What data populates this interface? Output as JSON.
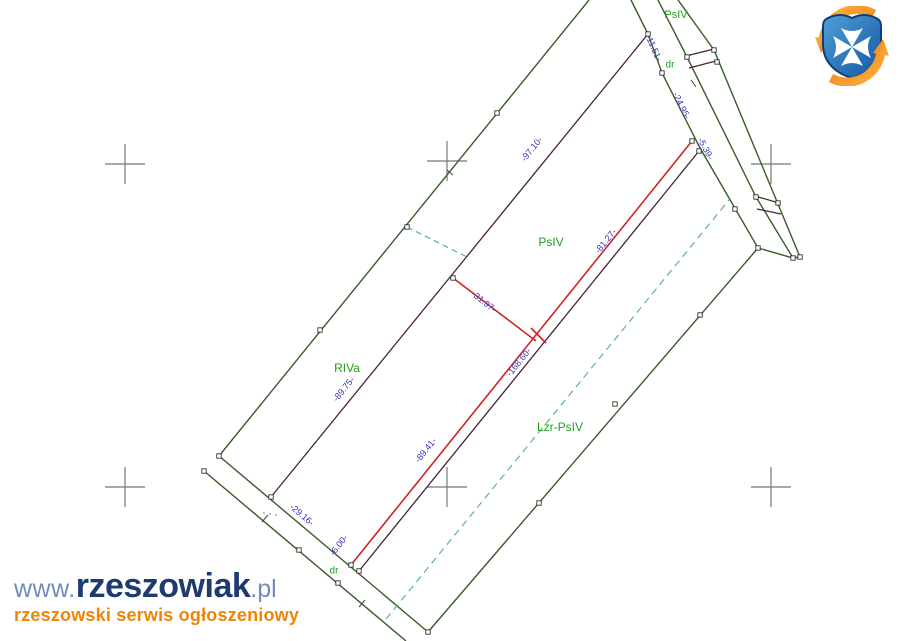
{
  "canvas": {
    "width": 900,
    "height": 641,
    "background": "#ffffff"
  },
  "colors": {
    "boundary": "#3a5c28",
    "inner": "#4a2433",
    "red": "#cf2323",
    "dashed": "#5cb87e",
    "measure": "#3434bb",
    "parcel": "#1fa01f",
    "cross": "#787878",
    "marker_fill": "#ffffff",
    "marker_stroke": "#333333",
    "tick": "#444444",
    "crest_blue_light": "#4f9fd8",
    "crest_blue_dark": "#1356a0",
    "crest_orange": "#f6921e",
    "wm_blue_light": "#6f8cba",
    "wm_blue_dark": "#1e3a6e",
    "wm_orange": "#ee8508"
  },
  "map": {
    "lines": [
      {
        "name": "outer-nw-boundary",
        "color": "boundary",
        "width": 1.4,
        "points": [
          [
            219,
            456
          ],
          [
            589,
            0
          ]
        ]
      },
      {
        "name": "outer-sw-boundary",
        "color": "boundary",
        "width": 1.4,
        "points": [
          [
            219,
            456
          ],
          [
            428,
            632
          ]
        ]
      },
      {
        "name": "road-sw-lower-edge",
        "color": "boundary",
        "width": 1.4,
        "points": [
          [
            204,
            471
          ],
          [
            406,
            641
          ]
        ]
      },
      {
        "name": "outer-se-boundary",
        "color": "boundary",
        "width": 1.4,
        "points": [
          [
            428,
            632
          ],
          [
            758,
            248
          ]
        ]
      },
      {
        "name": "road-ne-edge-a",
        "color": "boundary",
        "width": 1.4,
        "points": [
          [
            631,
            0
          ],
          [
            648,
            34
          ],
          [
            662,
            73
          ],
          [
            700,
            148
          ],
          [
            758,
            248
          ]
        ]
      },
      {
        "name": "road-ne-edge-b",
        "color": "boundary",
        "width": 1.4,
        "points": [
          [
            658,
            0
          ],
          [
            687,
            57
          ],
          [
            756,
            197
          ],
          [
            793,
            258
          ]
        ]
      },
      {
        "name": "road-ne-edge-c",
        "color": "boundary",
        "width": 1.4,
        "points": [
          [
            678,
            0
          ],
          [
            714,
            50
          ],
          [
            800,
            257
          ]
        ]
      },
      {
        "name": "road-ne-bottom-edge",
        "color": "boundary",
        "width": 1.4,
        "points": [
          [
            758,
            248
          ],
          [
            793,
            258
          ],
          [
            800,
            257
          ]
        ]
      },
      {
        "name": "inner-boundary-long",
        "color": "inner",
        "width": 1.3,
        "points": [
          [
            648,
            34
          ],
          [
            271,
            497
          ]
        ]
      },
      {
        "name": "inner-boundary-parallel",
        "color": "inner",
        "width": 1.3,
        "points": [
          [
            359,
            571
          ],
          [
            699,
            151
          ]
        ]
      },
      {
        "name": "road-rung-1",
        "color": "inner",
        "width": 1.2,
        "points": [
          [
            686,
            56
          ],
          [
            714,
            49
          ]
        ]
      },
      {
        "name": "road-rung-2",
        "color": "inner",
        "width": 1.2,
        "points": [
          [
            689,
            68
          ],
          [
            716,
            61
          ]
        ]
      },
      {
        "name": "road-rung-3",
        "color": "inner",
        "width": 1.2,
        "points": [
          [
            755,
            196
          ],
          [
            779,
            203
          ]
        ]
      },
      {
        "name": "road-rung-4",
        "color": "inner",
        "width": 1.2,
        "points": [
          [
            757,
            209
          ],
          [
            781,
            214
          ]
        ]
      },
      {
        "name": "division-red-main",
        "color": "red",
        "width": 1.6,
        "points": [
          [
            351,
            565
          ],
          [
            692,
            141
          ]
        ]
      },
      {
        "name": "division-red-spur",
        "color": "red",
        "width": 1.6,
        "points": [
          [
            453,
            278
          ],
          [
            536,
            341
          ]
        ]
      },
      {
        "name": "division-red-tick",
        "color": "red",
        "width": 1.6,
        "points": [
          [
            531,
            328
          ],
          [
            546,
            343
          ]
        ]
      },
      {
        "name": "dashed-connector",
        "color": "dashed",
        "width": 1.2,
        "dash": "6,4",
        "points": [
          [
            407,
            227
          ],
          [
            467,
            257
          ]
        ]
      },
      {
        "name": "dashed-long",
        "color": "dashed",
        "width": 1.2,
        "dash": "7,5",
        "points": [
          [
            386,
            619
          ],
          [
            729,
            200
          ]
        ]
      }
    ],
    "measurements": [
      {
        "text": "-11.51-",
        "x": 651,
        "y": 49,
        "rot": 66
      },
      {
        "text": "-24.95-",
        "x": 679,
        "y": 107,
        "rot": 64
      },
      {
        "text": "-5.39-",
        "x": 703,
        "y": 150,
        "rot": 62
      },
      {
        "text": "-97.10-",
        "x": 534,
        "y": 151,
        "rot": -51
      },
      {
        "text": "-81.27-",
        "x": 608,
        "y": 243,
        "rot": -51
      },
      {
        "text": "-31.97-",
        "x": 482,
        "y": 304,
        "rot": 38
      },
      {
        "text": "-168.60-",
        "x": 521,
        "y": 364,
        "rot": -51
      },
      {
        "text": "-89.75-",
        "x": 346,
        "y": 391,
        "rot": -51
      },
      {
        "text": "-89.41-",
        "x": 428,
        "y": 452,
        "rot": -51
      },
      {
        "text": "-29.16-",
        "x": 300,
        "y": 517,
        "rot": 40
      },
      {
        "text": "-6.00-",
        "x": 341,
        "y": 547,
        "rot": -52
      }
    ],
    "parcel_labels": [
      {
        "text": "PsIV",
        "x": 676,
        "y": 14,
        "size": 11
      },
      {
        "text": "dr",
        "x": 670,
        "y": 64,
        "size": 10
      },
      {
        "text": "PsIV",
        "x": 551,
        "y": 242,
        "size": 12
      },
      {
        "text": "RIVa",
        "x": 347,
        "y": 368,
        "size": 12
      },
      {
        "text": "Lzr-PsIV",
        "x": 560,
        "y": 427,
        "size": 12
      },
      {
        "text": "dr",
        "x": 334,
        "y": 570,
        "size": 10
      }
    ],
    "markers": [
      [
        497,
        113
      ],
      [
        407,
        227
      ],
      [
        320,
        330
      ],
      [
        219,
        456
      ],
      [
        271,
        497
      ],
      [
        204,
        471
      ],
      [
        299,
        550
      ],
      [
        338,
        583
      ],
      [
        428,
        632
      ],
      [
        539,
        503
      ],
      [
        615,
        404
      ],
      [
        700,
        315
      ],
      [
        758,
        248
      ],
      [
        648,
        34
      ],
      [
        662,
        73
      ],
      [
        735,
        209
      ],
      [
        687,
        57
      ],
      [
        756,
        197
      ],
      [
        793,
        258
      ],
      [
        714,
        50
      ],
      [
        717,
        62
      ],
      [
        778,
        203
      ],
      [
        800,
        257
      ],
      [
        453,
        278
      ],
      [
        351,
        565
      ],
      [
        359,
        571
      ],
      [
        692,
        141
      ],
      [
        699,
        151
      ]
    ],
    "ticks": [
      [
        447,
        170,
        453,
        175
      ],
      [
        262,
        522,
        268,
        515
      ],
      [
        359,
        607,
        365,
        600
      ],
      [
        691,
        80,
        696,
        87
      ]
    ],
    "dots": [
      [
        264,
        513
      ],
      [
        270,
        514
      ],
      [
        276,
        515
      ]
    ],
    "crosses": {
      "centers": [
        [
          125,
          164
        ],
        [
          447,
          161
        ],
        [
          771,
          164
        ],
        [
          125,
          487
        ],
        [
          447,
          487
        ],
        [
          771,
          487
        ]
      ],
      "arm": 20
    }
  },
  "watermark": {
    "www": "www.",
    "name": "rzeszowiak",
    "tld": ".pl",
    "tagline": "rzeszowski serwis ogłoszeniowy"
  },
  "crest": {
    "name": "rzeszow-crest"
  }
}
